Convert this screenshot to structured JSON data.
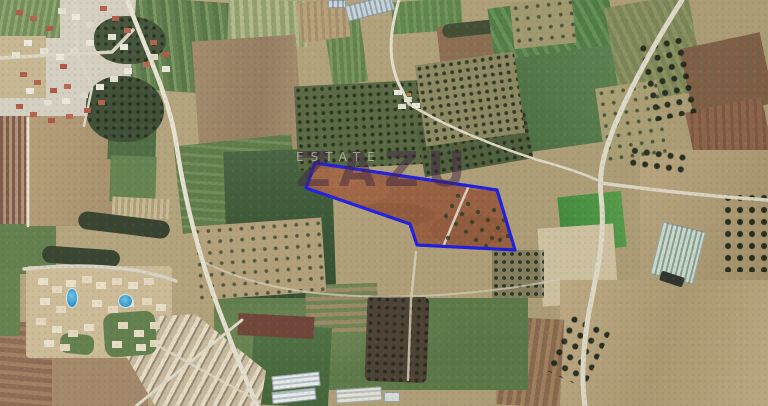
{
  "image": {
    "kind": "satellite-aerial-photo",
    "subject": "agricultural land parcel for sale outlined in blue, surrounded by farm fields, orchards, greenhouses and residential areas"
  },
  "watermark": {
    "brand": "ZAZU",
    "tagline": "ESTATE"
  },
  "parcel": {
    "points_svg": "315,163 306,188 410,224 417,245 515,250 497,190",
    "outline_color": "#1a18e8",
    "soil_color": "#9a5c3c"
  },
  "palette": {
    "parcel_outline_blue": "#1a18e8",
    "parcel_soil_brown": "#9a5c3c",
    "field_tan": "#b3a27a",
    "field_green": "#5d7a48",
    "field_dark_green": "#33512f",
    "orchard_dark": "#55663f",
    "pool_blue": "#2e9ad4",
    "road_light": "#e9e3d3",
    "roof_red": "#ad5340",
    "building_white": "#ece2cb"
  }
}
